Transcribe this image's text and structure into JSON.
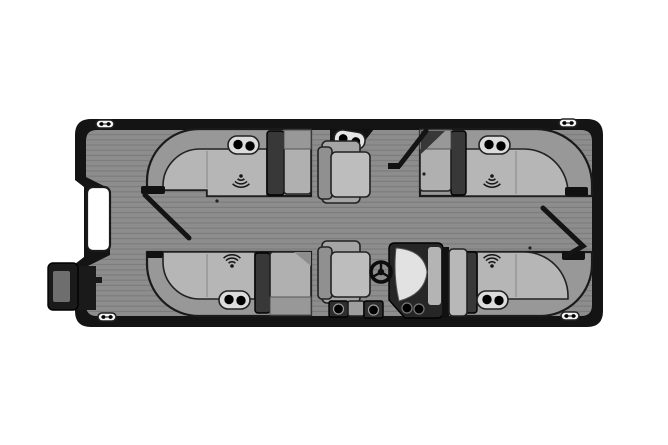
{
  "page": {
    "background_color": "#ffffff"
  },
  "palette": {
    "hull_outline": "#141414",
    "deck_base": "#8d8d8d",
    "deck_stripe": "#7b7b7b",
    "seat_backrest": "#989898",
    "seat_cushion": "#b6b6b6",
    "end_seat": "#b0b0b0",
    "armrest_block": "#383838",
    "dark_trim": "#111111",
    "chair_seat": "#bdbdbd",
    "chair_arm": "#a5a5a5",
    "chair_backrest": "#909090",
    "console_body": "#262626",
    "windshield": "#e2e2e2",
    "console_side_panel": "#b4b4b4",
    "partition_panel": "#b8b8b8",
    "step_dark": "#2e2e2e",
    "step_box": "#9e9e9e",
    "gate_panel": "#ffffff",
    "cleat_body": "#f5f5f5",
    "cup_holder_pill": "#dcdcdc",
    "cup_holder_hole": "#000000",
    "motor_housing": "#1a1a1a",
    "motor_inner": "#6e6e6e"
  },
  "diagram": {
    "type": "pontoon-boat-floorplan-top-view",
    "orientation": {
      "bow": "right",
      "stern": "left"
    },
    "cleats": {
      "count": 4,
      "positions": [
        "top-left",
        "top-right",
        "bottom-left",
        "bottom-right"
      ]
    },
    "lounges": [
      {
        "id": "lounge-top-left",
        "position": "top-left",
        "cup_holders": 2,
        "speaker": true,
        "armrest": true
      },
      {
        "id": "lounge-top-right",
        "position": "top-right",
        "cup_holders": 2,
        "speaker": true,
        "armrest": true
      },
      {
        "id": "lounge-bottom-left",
        "position": "bottom-left",
        "cup_holders": 2,
        "speaker": true,
        "armrest": true
      },
      {
        "id": "lounge-bottom-right",
        "position": "bottom-right",
        "cup_holders": 2,
        "speaker": true,
        "armrest": true
      }
    ],
    "helm": {
      "steering_wheel": true,
      "windshield": true,
      "cup_holders": 2,
      "side": "bottom-center"
    },
    "chairs": {
      "count": 2,
      "facing": "right"
    },
    "top_gate_console": {
      "cup_holders": 2
    },
    "helm_step": {
      "cup_holders": 2
    },
    "stern_gate": {
      "panel_color": "white",
      "motor_mounted": true
    },
    "open_gate_doors": 3
  },
  "icons": {
    "speaker": "sound-wave-arcs",
    "cup_holder": "black-circle",
    "cleat": "pill-with-two-dots",
    "steering_wheel": "ring-with-spokes"
  }
}
